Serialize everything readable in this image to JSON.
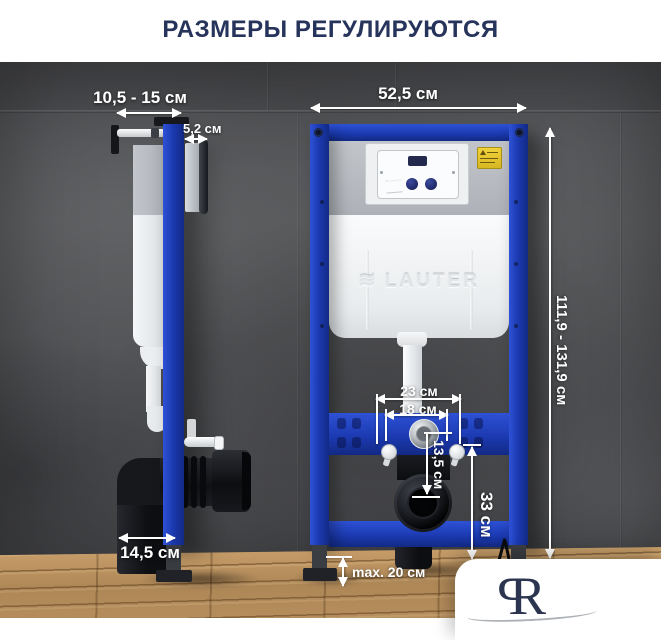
{
  "title": "РАЗМЕРЫ РЕГУЛИРУЮТСЯ",
  "brand": {
    "cistern_logo": "LAUTER",
    "cistern_logo_icon": "wave-icon",
    "monogram": [
      "P",
      "R"
    ]
  },
  "dimensions": {
    "depth_range": "10,5 - 15 см",
    "bracket_depth": "5,2 см",
    "frame_width": "52,5 см",
    "height_range": "111,9 - 131,9 см",
    "bolt_spacing_outer": "23 см",
    "bolt_spacing_inner": "18 см",
    "outlet_offset": "13,5 см",
    "outlet_height": "33 см",
    "base_depth": "14,5 см",
    "leg_adjustment": "max. 20 см"
  },
  "colors": {
    "frame_blue": "#1c3ab2",
    "title_navy": "#26335b",
    "dimension_text": "#ffffff",
    "sticker_yellow": "#e6c52e",
    "wall_gray": "#515356",
    "floor_wood": "#b08b58",
    "monogram_navy": "#2b3550"
  }
}
